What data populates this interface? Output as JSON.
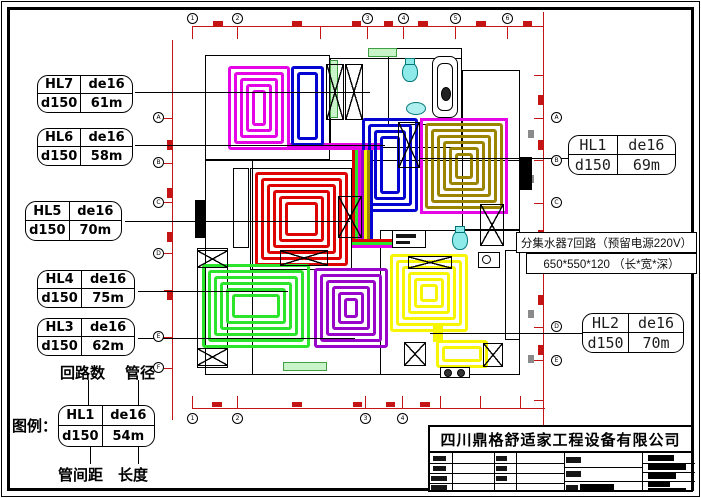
{
  "labels": {
    "left": [
      {
        "id": "HL7",
        "pipe": "de16",
        "spacing": "d150",
        "length": "61m"
      },
      {
        "id": "HL6",
        "pipe": "de16",
        "spacing": "d150",
        "length": "58m"
      },
      {
        "id": "HL5",
        "pipe": "de16",
        "spacing": "d150",
        "length": "70m"
      },
      {
        "id": "HL4",
        "pipe": "de16",
        "spacing": "d150",
        "length": "75m"
      },
      {
        "id": "HL3",
        "pipe": "de16",
        "spacing": "d150",
        "length": "62m"
      }
    ],
    "right": [
      {
        "id": "HL1",
        "pipe": "de16",
        "spacing": "d150",
        "length": "69m"
      },
      {
        "id": "HL2",
        "pipe": "de16",
        "spacing": "d150",
        "length": "70m"
      }
    ]
  },
  "legend": {
    "title": "图例：",
    "sample": {
      "id": "HL1",
      "pipe": "de16",
      "spacing": "d150",
      "length": "54m"
    },
    "callouts": {
      "top_left": "回路数",
      "top_right": "管径",
      "bottom_left": "管间距",
      "bottom_right": "长度"
    }
  },
  "annotations": {
    "line1": "分集水器7回路（预留电源220V）",
    "line2": "650*550*120 （长*宽*深）"
  },
  "title_block": {
    "company": "四川鼎格舒适家工程设备有限公司"
  },
  "axes": {
    "top": [
      "1",
      "2",
      "3",
      "4",
      "5",
      "6"
    ],
    "bottom": [
      "1",
      "2",
      "3",
      "4"
    ],
    "left": [
      "A",
      "B",
      "C",
      "D",
      "E",
      "F"
    ],
    "right": [
      "A",
      "B",
      "C",
      "D",
      "E"
    ]
  },
  "colors": {
    "dimension_red": "#c41414",
    "loop_hl7_magenta": "#e504e5",
    "loop_hl6_blue": "#0404d2",
    "loop_hl1_olive": "#9a8400",
    "loop_hl5_red": "#df0404",
    "loop_hl4_green": "#2ce42c",
    "loop_hl3_purple": "#9804c8",
    "loop_hl2_yellow": "#f6f604",
    "fixture_cyan": "#17c8c8",
    "window_green": "#c9f3c9"
  }
}
